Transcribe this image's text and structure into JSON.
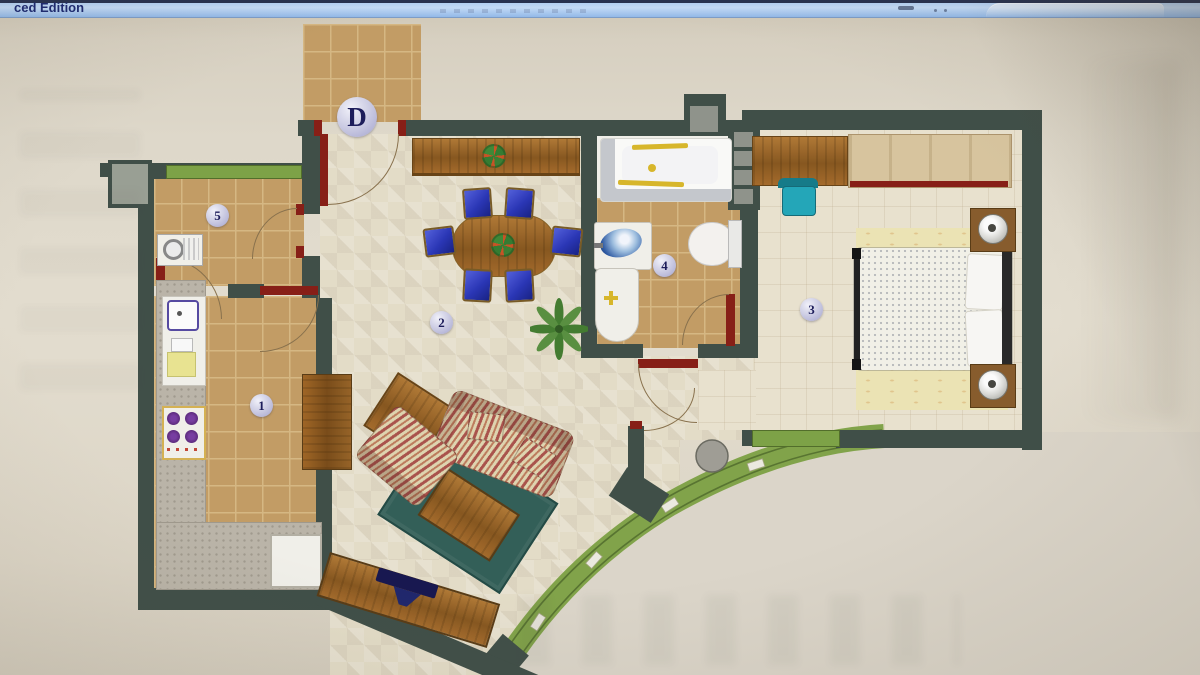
{
  "window": {
    "title_fragment": "ced Edition"
  },
  "plan": {
    "entrance_label": "D",
    "markers": [
      {
        "label": "1"
      },
      {
        "label": "2"
      },
      {
        "label": "3"
      },
      {
        "label": "4"
      },
      {
        "label": "5"
      }
    ],
    "colors": {
      "wall": "#3d4e46",
      "tile": "#c79d60",
      "tile_line": "#dab97f",
      "floor": "#e7dfc8",
      "parquet": "#ece4cf",
      "terrace": "#7fa542",
      "terrace_line": "#55742a",
      "door": "#8e1a12",
      "chair": "#2633c0",
      "rug": "#2e5f57",
      "counter": "#bcb6a8",
      "wood": "#9a6220",
      "window": "#7ba43f",
      "outside": "#ded8ca",
      "badge": "#c9c9e2"
    }
  }
}
